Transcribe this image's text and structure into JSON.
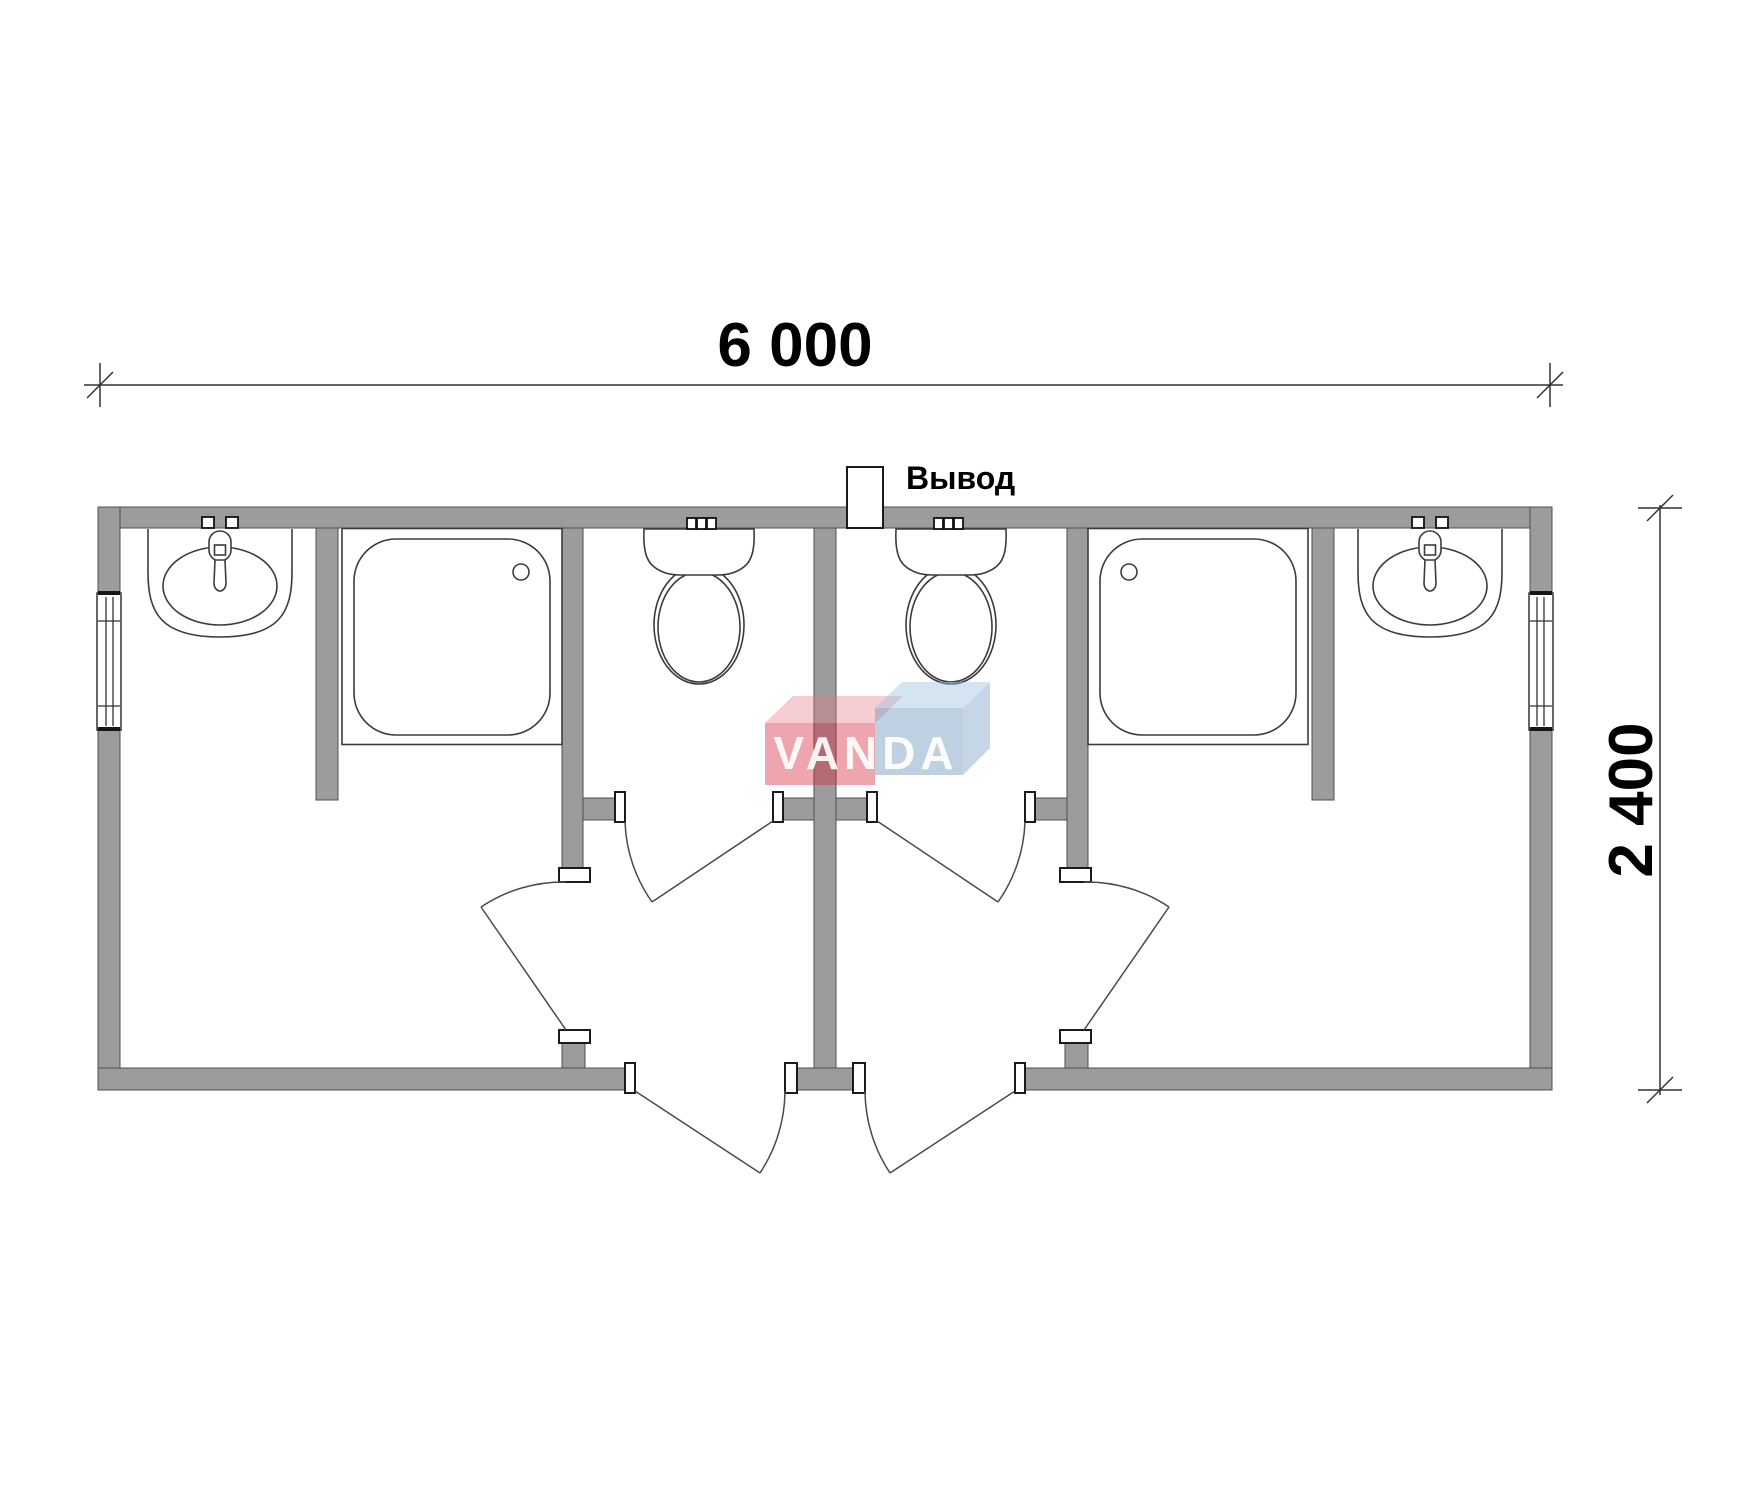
{
  "page": {
    "background": "#ffffff"
  },
  "plan": {
    "type": "floor-plan",
    "subject": "modular sanitary container with two mirrored washroom units",
    "dimensions": {
      "width_label": "6 000",
      "height_label": "2 400"
    },
    "outlet": {
      "label": "Вывод"
    },
    "watermark": {
      "text": "VANDA",
      "red": "#d6283c",
      "blue": "#6e96be"
    },
    "colors": {
      "wall_fill": "#9c9c9c",
      "line": "#3c3c3c",
      "dimension_text": "#000000",
      "background": "#ffffff"
    },
    "rooms": {
      "left_unit": {
        "fixtures": [
          "washbasin",
          "shower-tray",
          "toilet"
        ],
        "doors": [
          "entrance-door",
          "washroom-door",
          "toilet-door"
        ],
        "window": true
      },
      "right_unit": {
        "fixtures": [
          "washbasin",
          "shower-tray",
          "toilet"
        ],
        "doors": [
          "entrance-door",
          "washroom-door",
          "toilet-door"
        ],
        "window": true
      }
    }
  }
}
